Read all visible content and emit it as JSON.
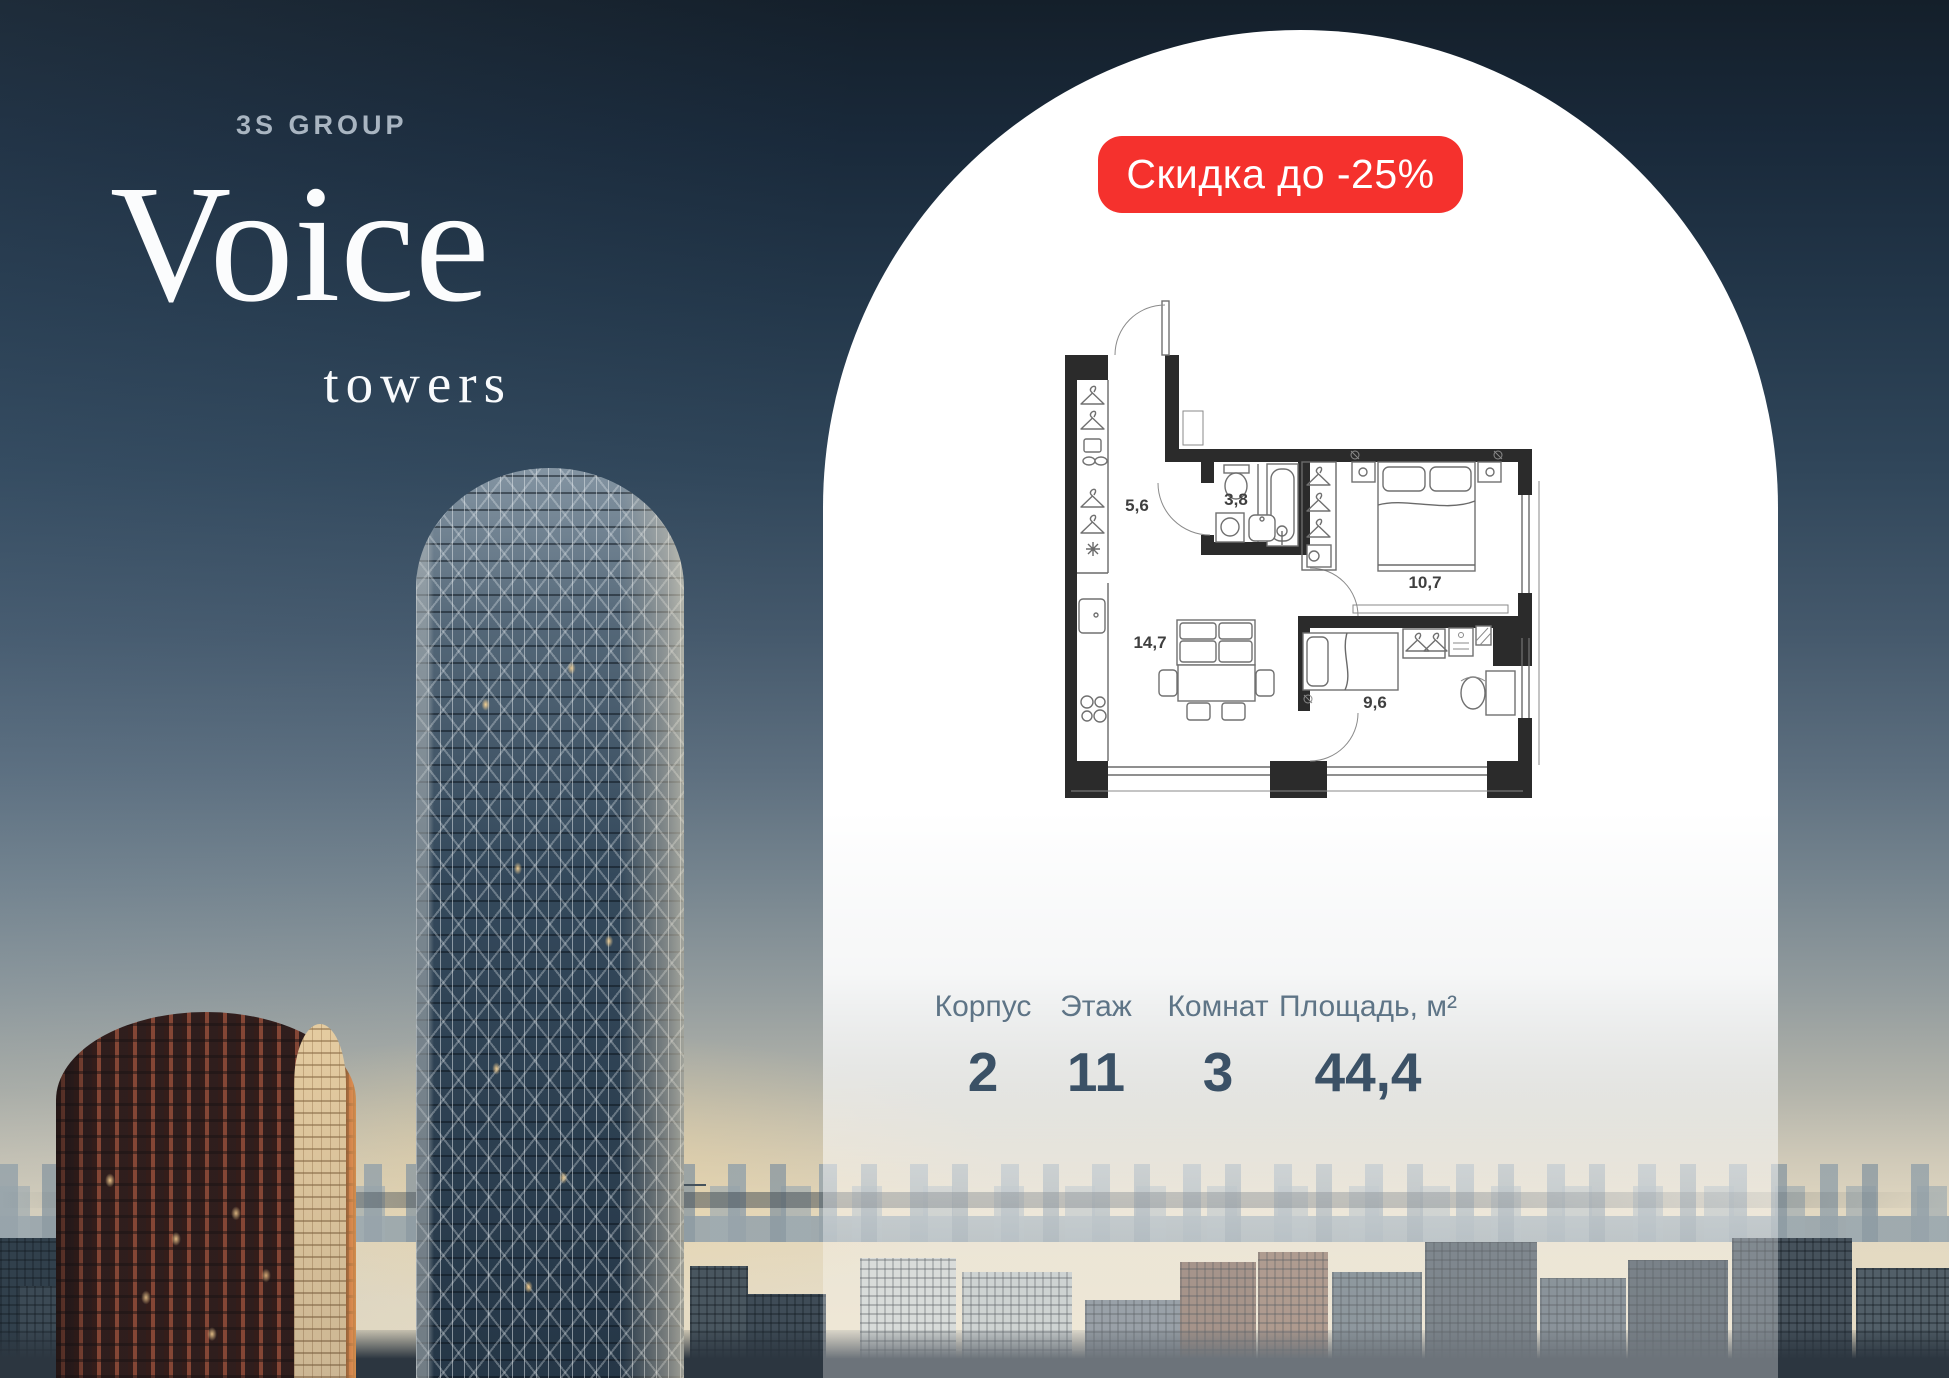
{
  "brand": {
    "developer": "3S GROUP",
    "project": "Voice",
    "project_suffix": "towers"
  },
  "badge": {
    "label": "Скидка до -25%"
  },
  "floorplan": {
    "rooms": [
      {
        "id": "hallway",
        "area": "5,6"
      },
      {
        "id": "bathroom",
        "area": "3,8"
      },
      {
        "id": "bedroom-main",
        "area": "10,7"
      },
      {
        "id": "living-kitchen",
        "area": "14,7"
      },
      {
        "id": "bedroom-second",
        "area": "9,6"
      }
    ]
  },
  "stats": [
    {
      "label": "Корпус",
      "value": "2"
    },
    {
      "label": "Этаж",
      "value": "11"
    },
    {
      "label": "Комнат",
      "value": "3"
    },
    {
      "label": "Площадь, м²",
      "value": "44,4"
    }
  ],
  "colors": {
    "badge_bg": "#f5312d",
    "stat_label": "#5e7486",
    "stat_value": "#3b5166",
    "developer_text": "#a9b5c1"
  }
}
